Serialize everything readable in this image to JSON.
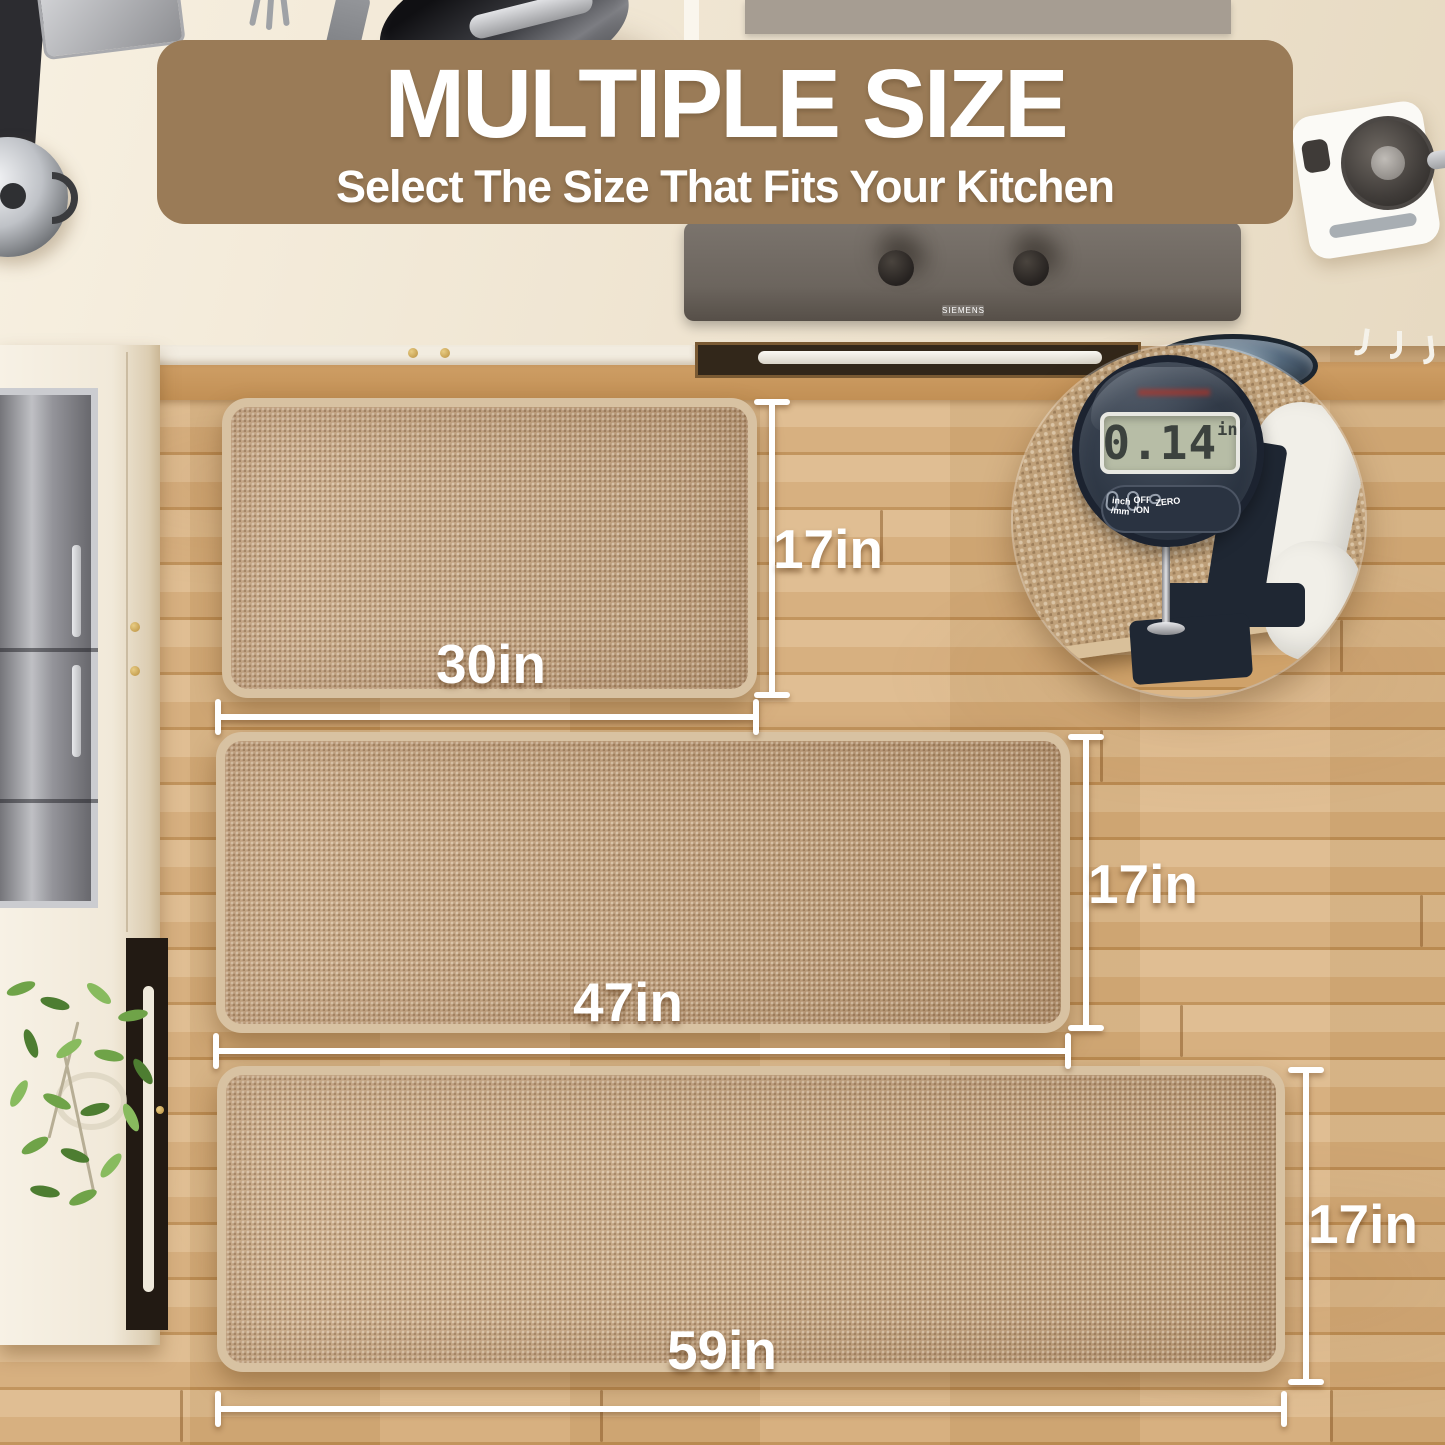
{
  "banner": {
    "title": "MULTIPLE SIZE",
    "subtitle": "Select The Size That Fits Your Kitchen"
  },
  "mats": [
    {
      "name": "small",
      "width_label": "30in",
      "height_label": "17in"
    },
    {
      "name": "medium",
      "width_label": "47in",
      "height_label": "17in"
    },
    {
      "name": "large",
      "width_label": "59in",
      "height_label": "17in"
    }
  ],
  "thickness_gauge": {
    "reading": "0.14",
    "unit": "in",
    "buttons": [
      {
        "line1": "inch",
        "line2": "/mm"
      },
      {
        "line1": "OFF",
        "line2": "/ON"
      },
      {
        "line1": "ZERO",
        "line2": ""
      }
    ]
  },
  "appliances": {
    "cooktop_brand": "SIEMENS"
  },
  "colors": {
    "banner_bg": "#9a7b57",
    "label_text": "#ffffff",
    "mat": "#c5a480",
    "mat_border": "#d8c2a2",
    "floor": "#d5ab79"
  }
}
